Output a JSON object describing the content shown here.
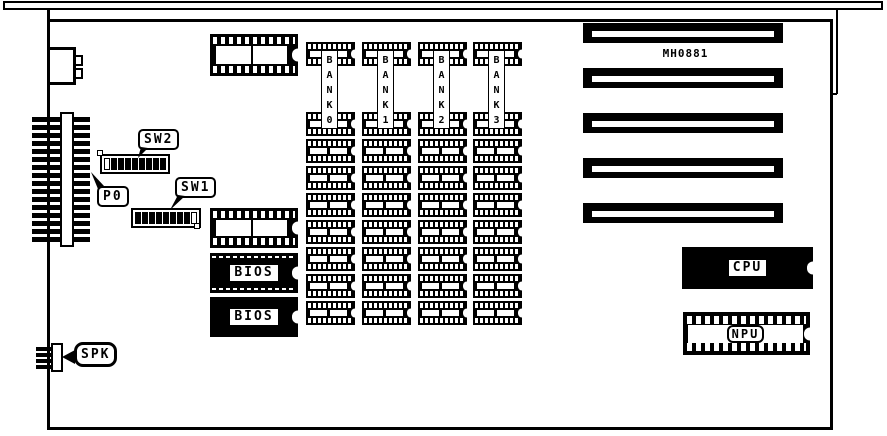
{
  "board": {
    "part_number": "MH0881",
    "slots": {
      "count": 5
    },
    "banks": {
      "labels": [
        "BANK0",
        "BANK1",
        "BANK2",
        "BANK3"
      ],
      "sockets_per_bank": 9
    },
    "switches": {
      "sw2": {
        "label": "SW2",
        "cells": [
          0,
          1,
          1,
          1,
          1,
          1,
          1,
          1,
          1
        ]
      },
      "sw1": {
        "label": "SW1",
        "cells": [
          1,
          1,
          1,
          1,
          1,
          1,
          1,
          1,
          0
        ]
      }
    },
    "connectors": {
      "p0_label": "P0",
      "spk_label": "SPK",
      "p0_pin_count": 16,
      "spk_pin_count": 4
    },
    "chips": {
      "cpu": "CPU",
      "npu": "NPU",
      "bios_top": "BIOS",
      "bios_bottom": "BIOS"
    },
    "colors": {
      "ink": "#000000",
      "paper": "#ffffff"
    }
  }
}
